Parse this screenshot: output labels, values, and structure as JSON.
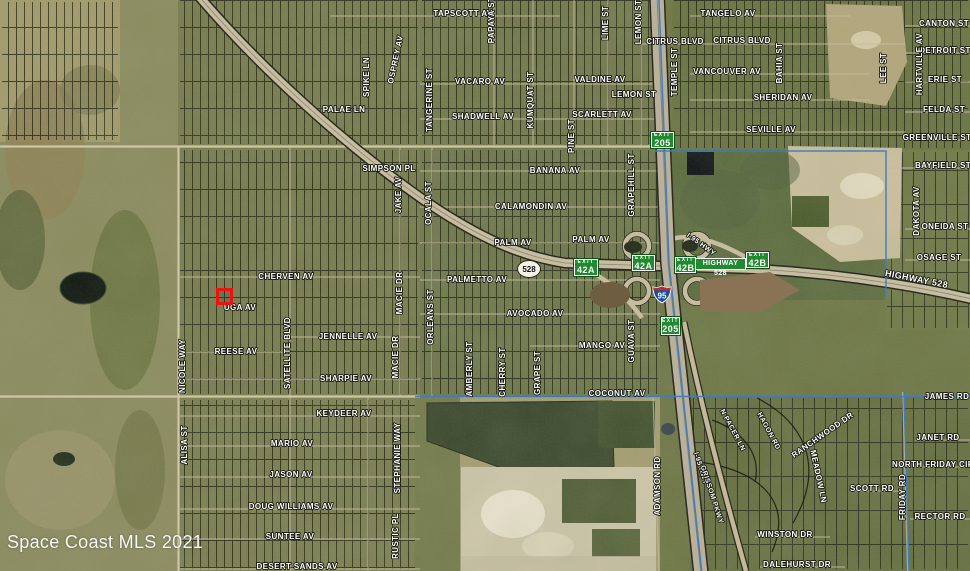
{
  "map": {
    "attribution": "Space Coast MLS 2021",
    "colors": {
      "exit_sign_green": "#1f8a2e",
      "marker_red": "#ee1111",
      "interstate_blue": "#1c4f9c",
      "interstate_red": "#bf2a33",
      "boundary_blue": "#3e7cc0",
      "label_white": "#ffffff"
    },
    "shields": {
      "interstate": "95",
      "state_road": "528"
    },
    "highway_sign": "HIGHWAY 528",
    "marker": {
      "x": 216,
      "y": 288,
      "width": 17,
      "height": 17
    },
    "exit_signs": [
      {
        "line1": "EXIT",
        "line2": "205",
        "x": 651,
        "y": 132,
        "w": 23,
        "h": 16
      },
      {
        "line1": "EXIT",
        "line2": "42A",
        "x": 574,
        "y": 259,
        "w": 24,
        "h": 17
      },
      {
        "line1": "EXIT",
        "line2": "42A",
        "x": 632,
        "y": 255,
        "w": 23,
        "h": 16
      },
      {
        "line1": "EXIT",
        "line2": "42B",
        "x": 675,
        "y": 257,
        "w": 21,
        "h": 16
      },
      {
        "line1": "EXIT",
        "line2": "42B",
        "x": 746,
        "y": 252,
        "w": 23,
        "h": 16
      },
      {
        "line1": "EXIT",
        "line2": "205",
        "x": 661,
        "y": 317,
        "w": 19,
        "h": 18
      }
    ],
    "street_labels": [
      {
        "t": "TAPSCOTT AV",
        "x": 463,
        "y": 16
      },
      {
        "t": "TANGELO AV",
        "x": 728,
        "y": 16
      },
      {
        "t": "CANTON ST",
        "x": 944,
        "y": 26
      },
      {
        "t": "CITRUS BLVD",
        "x": 675,
        "y": 44
      },
      {
        "t": "CITRUS BLVD",
        "x": 742,
        "y": 43
      },
      {
        "t": "DETROIT ST",
        "x": 945,
        "y": 53
      },
      {
        "t": "VACARO AV",
        "x": 480,
        "y": 84
      },
      {
        "t": "VALDINE AV",
        "x": 600,
        "y": 82
      },
      {
        "t": "VANCOUVER AV",
        "x": 727,
        "y": 74
      },
      {
        "t": "ERIE ST",
        "x": 945,
        "y": 82
      },
      {
        "t": "LEMON ST",
        "x": 634,
        "y": 97
      },
      {
        "t": "SHERIDAN AV",
        "x": 783,
        "y": 100
      },
      {
        "t": "PALAE LN",
        "x": 344,
        "y": 112
      },
      {
        "t": "FELDA ST",
        "x": 944,
        "y": 112
      },
      {
        "t": "SHADWELL AV",
        "x": 483,
        "y": 119
      },
      {
        "t": "SCARLETT AV",
        "x": 602,
        "y": 117
      },
      {
        "t": "SEVILLE AV",
        "x": 771,
        "y": 132
      },
      {
        "t": "GREENVILLE ST",
        "x": 937,
        "y": 140
      },
      {
        "t": "BAYFIELD ST",
        "x": 943,
        "y": 168
      },
      {
        "t": "SIMPSON PL",
        "x": 389,
        "y": 171
      },
      {
        "t": "BANANA AV",
        "x": 555,
        "y": 173
      },
      {
        "t": "CALAMONDIN AV",
        "x": 531,
        "y": 209
      },
      {
        "t": "ONEIDA ST",
        "x": 945,
        "y": 229
      },
      {
        "t": "PALM AV",
        "x": 513,
        "y": 245
      },
      {
        "t": "PALM AV",
        "x": 591,
        "y": 242
      },
      {
        "t": "OSAGE ST",
        "x": 939,
        "y": 260
      },
      {
        "t": "CHERVEN AV",
        "x": 286,
        "y": 279
      },
      {
        "t": "PALMETTO AV",
        "x": 477,
        "y": 282
      },
      {
        "t": "HIGHWAY 528",
        "x": 916,
        "y": 282,
        "r": 11,
        "s": 9
      },
      {
        "t": "UGA AV",
        "x": 240,
        "y": 310
      },
      {
        "t": "AVOCADO AV",
        "x": 535,
        "y": 316
      },
      {
        "t": "JENNELLE AV",
        "x": 348,
        "y": 339
      },
      {
        "t": "MANGO AV",
        "x": 602,
        "y": 348
      },
      {
        "t": "REESE AV",
        "x": 236,
        "y": 354
      },
      {
        "t": "SHARPIE AV",
        "x": 346,
        "y": 381
      },
      {
        "t": "COCONUT AV",
        "x": 617,
        "y": 396
      },
      {
        "t": "JAMES RD",
        "x": 947,
        "y": 399
      },
      {
        "t": "KEYDEER AV",
        "x": 344,
        "y": 416
      },
      {
        "t": "MARIO AV",
        "x": 292,
        "y": 446
      },
      {
        "t": "JANET RD",
        "x": 938,
        "y": 440
      },
      {
        "t": "NORTH FRIDAY CIR",
        "x": 933,
        "y": 467
      },
      {
        "t": "JASON AV",
        "x": 291,
        "y": 477
      },
      {
        "t": "SCOTT RD",
        "x": 872,
        "y": 491
      },
      {
        "t": "DOUG WILLIAMS AV",
        "x": 291,
        "y": 509
      },
      {
        "t": "RECTOR RD",
        "x": 940,
        "y": 519
      },
      {
        "t": "WINSTON DR",
        "x": 785,
        "y": 537
      },
      {
        "t": "SUNTEE AV",
        "x": 290,
        "y": 539
      },
      {
        "t": "DALEHURST DR",
        "x": 797,
        "y": 567
      },
      {
        "t": "DESERT SANDS AV",
        "x": 297,
        "y": 569
      },
      {
        "t": "PAPAYA ST",
        "x": 494,
        "y": 20,
        "r": -90
      },
      {
        "t": "LIME ST",
        "x": 608,
        "y": 23,
        "r": -90
      },
      {
        "t": "LEMON ST",
        "x": 641,
        "y": 22,
        "r": -90
      },
      {
        "t": "OSPREY AV",
        "x": 398,
        "y": 60,
        "r": -78
      },
      {
        "t": "SPIKE LN",
        "x": 369,
        "y": 77,
        "r": -90
      },
      {
        "t": "TEMPLE ST",
        "x": 677,
        "y": 72,
        "r": -90
      },
      {
        "t": "BAHIA ST",
        "x": 782,
        "y": 63,
        "r": -90
      },
      {
        "t": "LEE ST",
        "x": 886,
        "y": 68,
        "r": -90
      },
      {
        "t": "HARTVILLE AV",
        "x": 922,
        "y": 64,
        "r": -90
      },
      {
        "t": "TANGERINE ST",
        "x": 432,
        "y": 100,
        "r": -90
      },
      {
        "t": "KUMQUAT ST",
        "x": 533,
        "y": 100,
        "r": -90
      },
      {
        "t": "PINE ST",
        "x": 574,
        "y": 136,
        "r": -90
      },
      {
        "t": "GRAPEHILL ST",
        "x": 634,
        "y": 185,
        "r": -90
      },
      {
        "t": "JAKE AV",
        "x": 401,
        "y": 195,
        "r": -90
      },
      {
        "t": "OCALA ST",
        "x": 431,
        "y": 203,
        "r": -90
      },
      {
        "t": "DAKOTA AV",
        "x": 919,
        "y": 211,
        "r": -90
      },
      {
        "t": "I-95 HWY",
        "x": 700,
        "y": 246,
        "r": 36,
        "s": 7
      },
      {
        "t": "MACIE DR",
        "x": 402,
        "y": 293,
        "r": -90
      },
      {
        "t": "ORLEANS ST",
        "x": 433,
        "y": 317,
        "r": -90
      },
      {
        "t": "GUAVA ST",
        "x": 634,
        "y": 341,
        "r": -90
      },
      {
        "t": "SATELLITE BLVD",
        "x": 290,
        "y": 353,
        "r": -90
      },
      {
        "t": "MACIE DR",
        "x": 398,
        "y": 357,
        "r": -90
      },
      {
        "t": "NICOLE WAY",
        "x": 185,
        "y": 366,
        "r": -90
      },
      {
        "t": "AMBERLY ST",
        "x": 472,
        "y": 369,
        "r": -90
      },
      {
        "t": "CHERRY ST",
        "x": 505,
        "y": 372,
        "r": -90
      },
      {
        "t": "GRAPE ST",
        "x": 540,
        "y": 373,
        "r": -90
      },
      {
        "t": "N PACER LN",
        "x": 731,
        "y": 431,
        "r": 62,
        "s": 7
      },
      {
        "t": "HAGON RD",
        "x": 767,
        "y": 432,
        "r": 62,
        "s": 7
      },
      {
        "t": "RANCHWOOD DR",
        "x": 824,
        "y": 437,
        "r": -35
      },
      {
        "t": "ALISA ST",
        "x": 187,
        "y": 445,
        "r": -90
      },
      {
        "t": "STEPHANIE WAY",
        "x": 400,
        "y": 458,
        "r": -90
      },
      {
        "t": "I-95 HWY",
        "x": 699,
        "y": 469,
        "r": 72,
        "s": 7
      },
      {
        "t": "MEADOW LN",
        "x": 816,
        "y": 477,
        "r": 78
      },
      {
        "t": "ADAMSON RD",
        "x": 660,
        "y": 486,
        "r": -90
      },
      {
        "t": "GRISSOM PKWY",
        "x": 710,
        "y": 495,
        "r": 72,
        "s": 7
      },
      {
        "t": "FRIDAY RD",
        "x": 905,
        "y": 497,
        "r": -90
      },
      {
        "t": "RUSTIC PL",
        "x": 398,
        "y": 536,
        "r": -90
      }
    ]
  }
}
